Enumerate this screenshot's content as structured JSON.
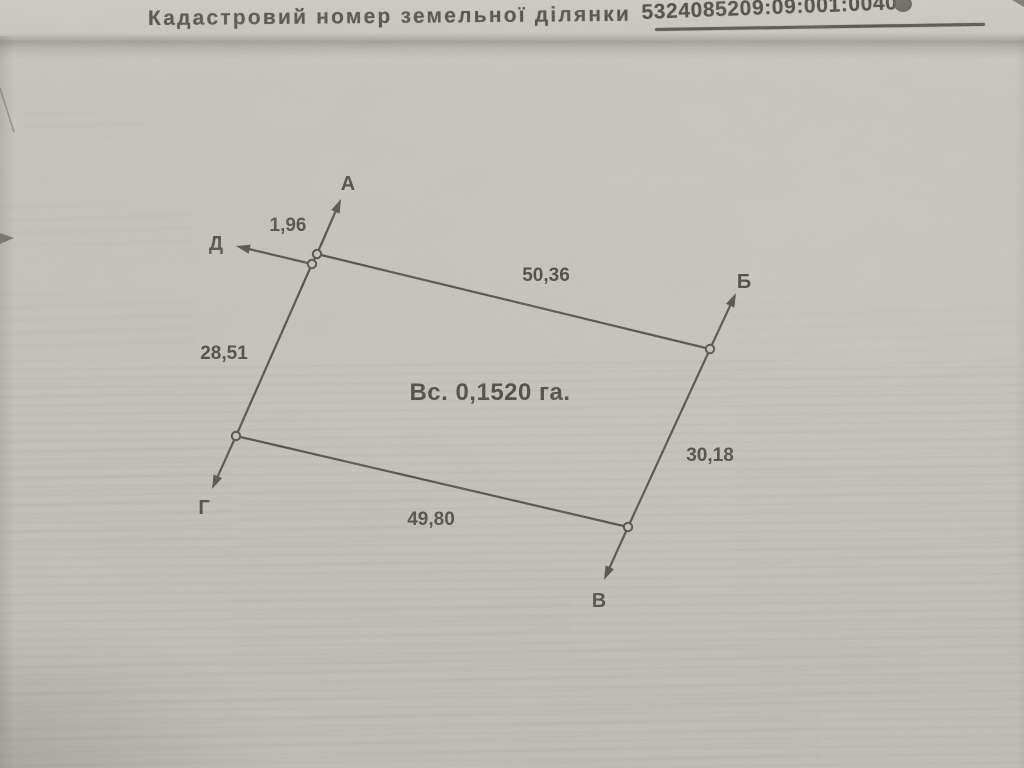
{
  "header": {
    "label": "Кадастровий номер земельної ділянки",
    "cadastral_number": "5324085209:09:001:0040"
  },
  "colors": {
    "paper": "#c9c8c1",
    "ink": "#26251f"
  },
  "plan": {
    "area_label": "Вс. 0,1520 га.",
    "area_label_pos": {
      "x": 490,
      "y": 400
    },
    "vertices": [
      {
        "name": "А",
        "x": 317,
        "y": 254,
        "arrow_tip_x": 341,
        "arrow_tip_y": 199,
        "label_x": 348,
        "label_y": 190
      },
      {
        "name": "Б",
        "x": 710,
        "y": 349,
        "arrow_tip_x": 736,
        "arrow_tip_y": 293,
        "label_x": 744,
        "label_y": 288
      },
      {
        "name": "В",
        "x": 628,
        "y": 527,
        "arrow_tip_x": 604,
        "arrow_tip_y": 580,
        "label_x": 599,
        "label_y": 607
      },
      {
        "name": "Г",
        "x": 236,
        "y": 436,
        "arrow_tip_x": 212,
        "arrow_tip_y": 489,
        "label_x": 204,
        "label_y": 514
      },
      {
        "name": "Д",
        "x": 312,
        "y": 264,
        "arrow_tip_x": 236,
        "arrow_tip_y": 246,
        "label_x": 216,
        "label_y": 250
      }
    ],
    "sides": [
      {
        "from": "Д",
        "to": "А",
        "length": "1,96",
        "label_x": 288,
        "label_y": 231
      },
      {
        "from": "А",
        "to": "Б",
        "length": "50,36",
        "label_x": 546,
        "label_y": 281
      },
      {
        "from": "Б",
        "to": "В",
        "length": "30,18",
        "label_x": 710,
        "label_y": 461
      },
      {
        "from": "В",
        "to": "Г",
        "length": "49,80",
        "label_x": 431,
        "label_y": 525
      },
      {
        "from": "Г",
        "to": "Д",
        "length": "28,51",
        "label_x": 224,
        "label_y": 359
      }
    ]
  }
}
